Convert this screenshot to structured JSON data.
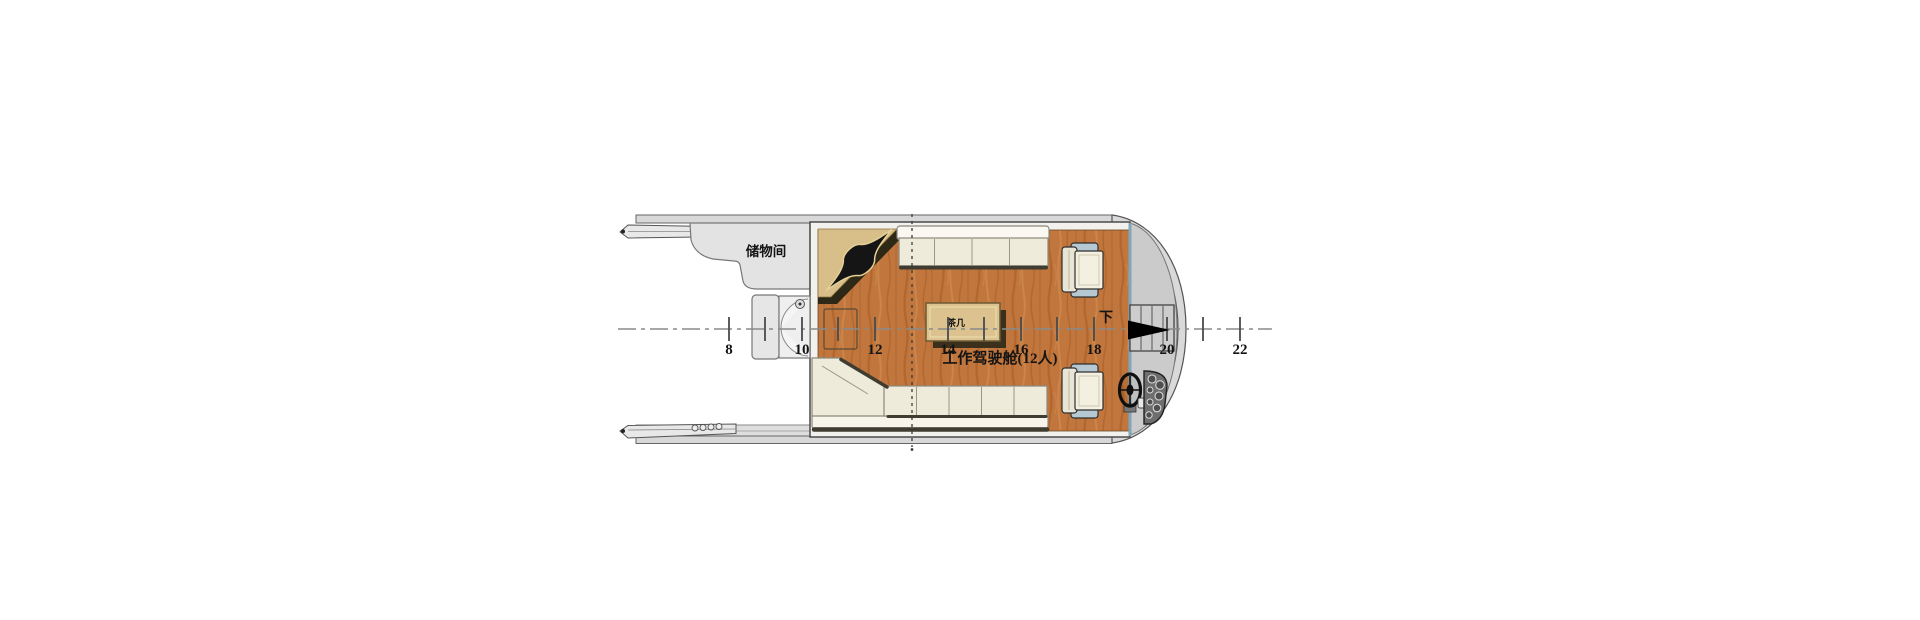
{
  "plan": {
    "type": "boat-deck-floor-plan",
    "labels": {
      "storage_room": "储物间",
      "cabin": "工作驾驶舱(12人)",
      "table": "茶几",
      "down": "下"
    },
    "stations": [
      {
        "label": "8"
      },
      {
        "label": "10"
      },
      {
        "label": "12"
      },
      {
        "label": "14"
      },
      {
        "label": "16"
      },
      {
        "label": "18"
      },
      {
        "label": "20"
      },
      {
        "label": "22"
      }
    ],
    "colors": {
      "background": "#ffffff",
      "deck_gray": "#d8d8d8",
      "foredeck_gray": "#cbcbcb",
      "wood_floor": "#c0763c",
      "counter_tan": "#d8be88",
      "bench_cream": "#efebdb",
      "bulkhead_blue": "#7fa6ba",
      "chair_accent": "#b6c8d2",
      "arrow_black": "#000000"
    }
  }
}
